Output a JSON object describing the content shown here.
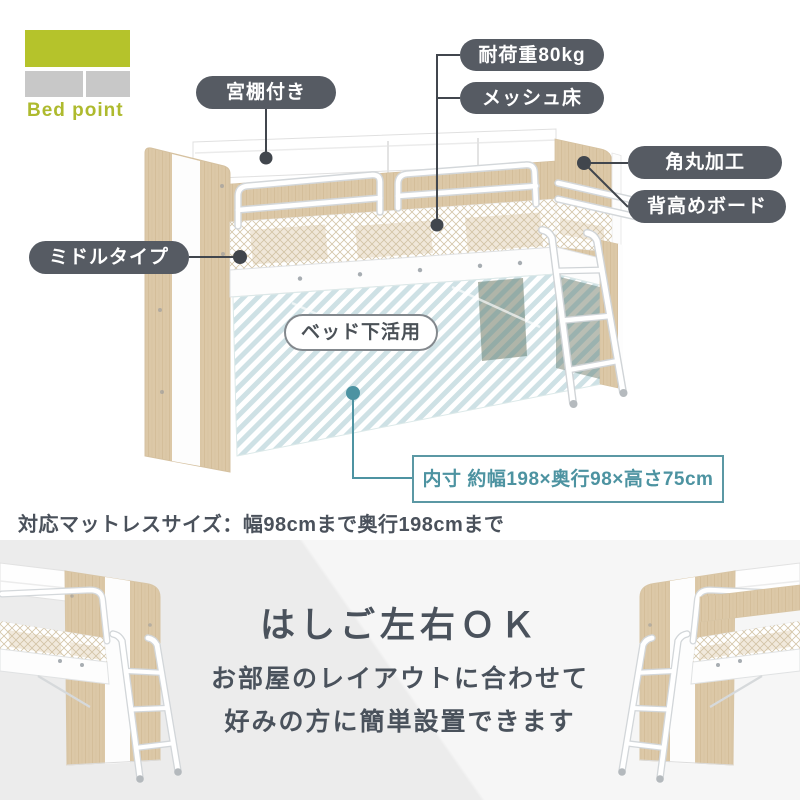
{
  "logo": {
    "title": "Bed point"
  },
  "callouts": {
    "shelf": "宮棚付き",
    "load": "耐荷重80kg",
    "mesh_floor": "メッシュ床",
    "rounded_corners": "角丸加工",
    "tall_board": "背高めボード",
    "middle_type": "ミドルタイプ",
    "under_bed": "ベッド下活用",
    "inner_dimensions": "内寸 約幅198×奥行98×高さ75cm"
  },
  "notes": {
    "mattress_size": "対応マットレスサイズ：幅98cmまで奥行198cmまで"
  },
  "bottom_section": {
    "heading": "はしご左右ＯＫ",
    "subline1": "お部屋のレイアウトに合わせて",
    "subline2": "好みの方に簡単設置できます"
  },
  "colors": {
    "accent_teal": "#4d93a1",
    "teal_stripe": "#cde4e3",
    "label_bg": "#565b63",
    "logo_green": "#b5c32b",
    "logo_gray": "#c8c8c8",
    "text_dark": "#4a525c",
    "wood": "#dcc8a7"
  }
}
